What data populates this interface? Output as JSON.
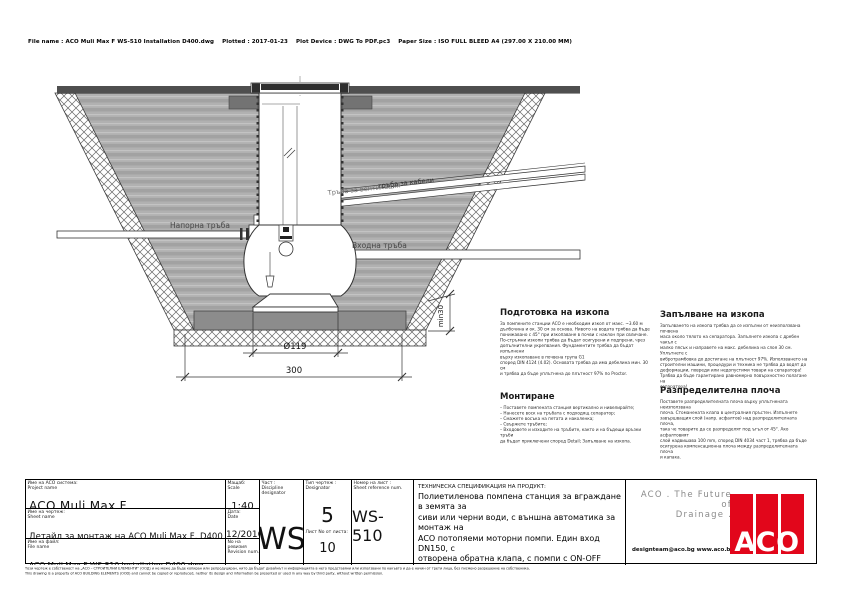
{
  "header": {
    "file_info": "File name : ACO Muli Max F WS-510 Installation D400.dwg    Plotted : 2017-01-23    Plot Device : DWG To PDF.pc3    Paper Size : ISO FULL BLEED A4 (297.00 X 210.00 MM)"
  },
  "drawing": {
    "labels": {
      "pressure_pipe": "Напорна тръба",
      "inlet_pipe": "Входна тръба",
      "vent_pipe": "Тръба за вентилация",
      "cable_pipe": "тръба за кабели",
      "dim_diameter": "Ø119",
      "dim_width": "300",
      "dim_depth": "min30"
    }
  },
  "notes": {
    "col1": [
      {
        "title": "Подготовка на изкопа",
        "body": "За помпените станции ACO е необходим изкоп от макс. ~3.60 м\nдълбочина и ок. 30 см за основа. Нивото на водата трябва да бъде\nпонижавано с 45° при изкопаване в почви с наклон при свличане.\nПо-стръмни изкопи трябва да бъдат осигурени и подпрени, чрез\nдопълнителни укрепвания. Фундаментите трябва да бъдат изпълнени\nвърху изкопаване в почвена група G1\nспоред DIN 4124 (4.02). Основата трябва да има дебелина мин. 30 см\nи трябва да бъде уплътнена до плътност 97% по Proctor."
      },
      {
        "title": "Монтиране",
        "body": "– Поставете помпената станция вертикално и нивелирайте;\n– Нанесете воск на тръбата с подходящ сепаратор;\n– Смажете восъка на петата и наколенка;\n– Свържете тръбите;\n– Входовете и изходите на тръбите, както и на бъдещи връзки тръби\nда бъдат приключени според Detail; Запълване на изкопа."
      }
    ],
    "col2": [
      {
        "title": "Запълване на изкопа",
        "body": "Запълването на изкопа трябва да се изпълни от неизползвана почвена\nмаса около тялото на сепаратора. Запълнете изкопа с дребен чакъл с\nмалко пясък и направете на макс. дебелина на слоя 30 см. Уплътнете с\nвибротрамбовка до достигане на плътност 97%. Използването на\nстроителни машини, процедури и техника не трябва да водят до\nдеформации, повреди или недопустими товари на сепаратора!\nТрябва да бъде гарантирано равномерно повърхностно полагане на\nсепаратора!"
      },
      {
        "title": "Разпределителна плоча",
        "body": "Поставете разпределителната плоча върху уплътнената неизползвана\nплоча. Стоманената клапа в централния пръстен. Изпълнете\nзавършващия слой (напр. асфалтов) над разпределителната плоча,\nтака че товарите да се разпределят под ъгъл от 45°. Ако асфалтовият\nслой надвишава 100 mm, според DIN 4034 част 1, трябва да бъде\nосигурена компенсационна плоча между разпределителната плоча\nи капака."
      }
    ]
  },
  "titleblock": {
    "info_rows": [
      {
        "label_bg": "Име на ACO система:",
        "label_en": "Project name",
        "value": "ACO Muli Max F"
      },
      {
        "label_bg": "Име на чертеж:",
        "label_en": "Sheet name",
        "value": "Детайл за монтаж на ACO Muli Max F, D400"
      },
      {
        "label_bg": "Име на файл:",
        "label_en": "File name",
        "value": "ACO Muli Max F WS-510 Installation D400.dwg"
      }
    ],
    "side_rows": [
      {
        "label_bg": "Мащаб:",
        "label_en": "Scale",
        "value": "1:40"
      },
      {
        "label_bg": "Дата:",
        "label_en": "Date",
        "value": "12/2016"
      },
      {
        "label_bg": "No на ревизия",
        "label_en": "Revision num.",
        "value": "0"
      }
    ],
    "discipline": {
      "label_bg": "Част :",
      "label_en": "Discipline designator",
      "value": "WS"
    },
    "type": {
      "label_bg": "Тип чертеж :",
      "label_en": "Designator",
      "value": "5",
      "sheet_label": "Лист No от листа:",
      "sheet_value": "10"
    },
    "sheet_ref": {
      "label_bg": "Номер на лист :",
      "label_en": "Sheet reference num.",
      "value": "WS-510"
    },
    "spec": {
      "title": "ТЕХНИЧЕСКА СПЕЦИФИКАЦИЯ НА ПРОДУКТ:",
      "body": "Полиетиленова помпена станция за вграждане в земята за\nсиви или черни води, с външна автоматика за монтаж на\nACO потопяеми моторни помпи. Един вход DN150, с\nотворена обратна клапа, с помпи с ON-OFF алармена\nфункция, DN100 връзка за кабел/ вентилация. Клас на\nнатоварване на капака D400, съгласно БДС EN 124."
    },
    "brand": {
      "tagline1": "ACO . The Future of",
      "tagline2": "Drainage .",
      "contacts": "designteam@aco.bg   www.aco.bg",
      "logo_text": "ACO",
      "logo_color": "#e2061b"
    }
  },
  "footer": {
    "line_bg": "Този чертеж е собственост на „АСО – СТРОИТЕЛНИ ЕЛЕМЕНТИ“ (ООД) и не може да бъде копиран или репродуциран, нито да бъдат дизайнът и информацията в него представяни или използвани по какъвто и да е начин от трети лица, без писмено разрешение на собственика.",
    "line_en": "This drawing is a property of ACO BUILDING ELEMENTS (OOD) and cannot be copied or reproduced, neither its design and information be presented or used in any way by third party, without written permission."
  }
}
